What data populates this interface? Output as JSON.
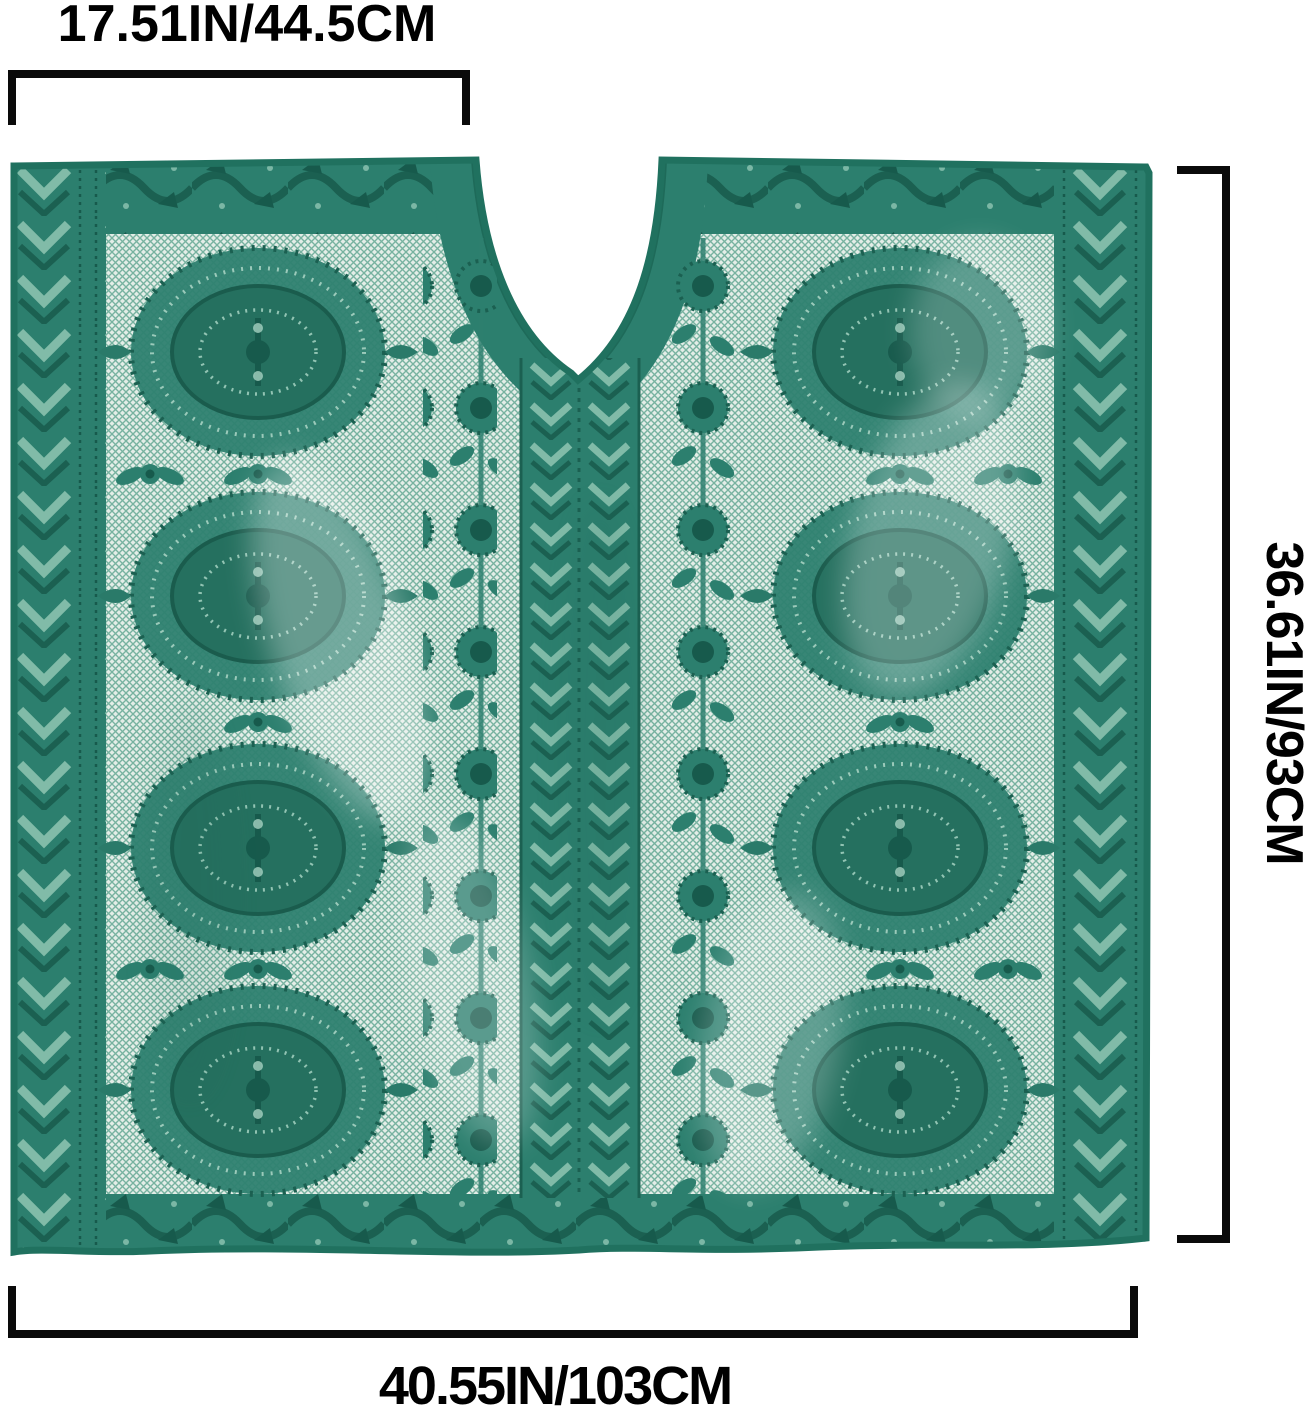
{
  "subject": "teal-green lace poncho cover-up shown flat with dimension annotations",
  "dimensions": {
    "top_width": "17.51IN/44.5CM",
    "side_height": "36.61IN/93CM",
    "bottom_width": "40.55IN/103CM"
  },
  "colors": {
    "annotation_text": "#000000",
    "bracket": "#0a0a0a",
    "garment_base": "#2c7f6e",
    "garment_dark_accent": "#1b6051",
    "garment_deep_accent": "#175a4c",
    "garment_mesh_light": "#a9cfc1",
    "background": "#ffffff"
  }
}
